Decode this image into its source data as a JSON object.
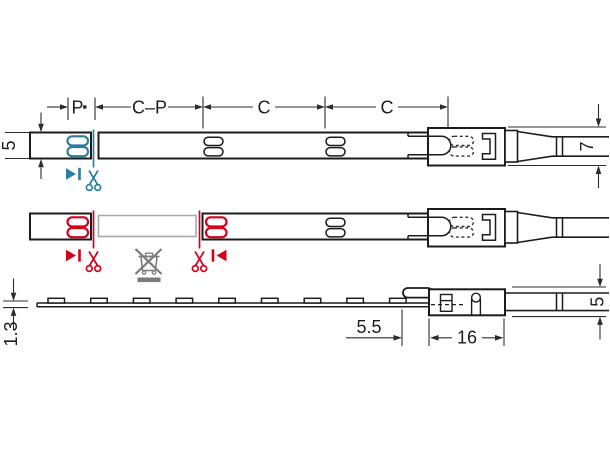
{
  "labels": {
    "p": "P",
    "c_p": "C–P",
    "c1": "C",
    "c2": "C",
    "strip_width": "5",
    "cable_width": "7",
    "strip_thickness": "1.3",
    "led_offset": "5.5",
    "connector_length": "16",
    "connector_height": "5"
  },
  "icons": {
    "cut_here": "scissors-icon",
    "cut_direction": "arrow-bar-marker-icon",
    "do_not_discard": "crossed-out-bin-icon"
  },
  "colors": {
    "background": "#ffffff",
    "line-dark": "#1c1c1c",
    "dim-line": "#2c2c2c",
    "cut-blue": "#2e7d9c",
    "cut-red": "#d6001d",
    "removed-gray": "#a9a9a9",
    "disposal-gray": "#7b7b7b"
  }
}
